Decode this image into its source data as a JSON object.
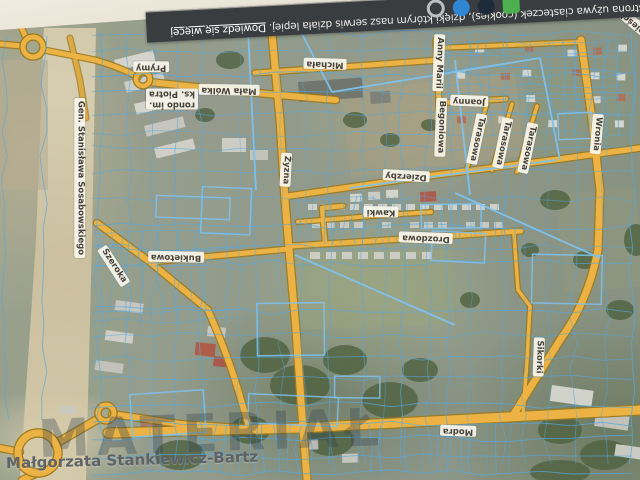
{
  "photo": {
    "background_color": "#e7e2d4"
  },
  "banner": {
    "bg_color": "#393d3f",
    "message": "Ta strona używa ciasteczek (cookies), dzięki którym nasz serwis działa lepiej. ",
    "link_label": "Dowiedz się więcej",
    "icons": [
      {
        "name": "green-app-icon",
        "shape": "square",
        "color": "#4caf50"
      },
      {
        "name": "dark-circle-icon",
        "shape": "circle",
        "color": "#1d2b3a"
      },
      {
        "name": "blue-circle-icon",
        "shape": "circle",
        "color": "#2f87d4"
      },
      {
        "name": "ring-icon",
        "shape": "ring",
        "color": "#b9bfc2"
      }
    ]
  },
  "map": {
    "colors": {
      "road_fill": "#ecb244",
      "road_casing": "#9c7a1e",
      "parcel_line": "#55a8e0",
      "parcel_strong": "#7ec2ee",
      "label_bg": "#f8f5ec",
      "label_text": "#46423a",
      "sand": "#d2c6a6",
      "banner_bg": "#393d3f"
    },
    "watermark_text": "MATERIAŁ",
    "credit_text": "Małgorzata Stankiewicz-Bartz",
    "street_labels": [
      {
        "id": "gen-stanislawa-sosabowskiego",
        "text": "Gen. Stanisława Sosabowskiego",
        "x": 80,
        "y": 178,
        "rot": 90
      },
      {
        "id": "szeroka",
        "text": "Szeroka",
        "x": 114,
        "y": 266,
        "rot": 57
      },
      {
        "id": "bukietowa",
        "text": "Bukietowa",
        "x": 176,
        "y": 257,
        "rot": 181
      },
      {
        "id": "zyzna",
        "text": "Żyzna",
        "x": 286,
        "y": 170,
        "rot": 93
      },
      {
        "id": "mala-wolka",
        "text": "Mała Wólka",
        "x": 229,
        "y": 90,
        "rot": 181
      },
      {
        "id": "rondo-ks-piotra",
        "text": "rondo im.\nks. Piotra",
        "x": 172,
        "y": 99,
        "rot": 180
      },
      {
        "id": "prymy",
        "text": "Prymy",
        "x": 151,
        "y": 67,
        "rot": 180
      },
      {
        "id": "michala",
        "text": "Michała",
        "x": 325,
        "y": 64,
        "rot": 182
      },
      {
        "id": "anny-marii",
        "text": "Anny Marii",
        "x": 439,
        "y": 63,
        "rot": 92
      },
      {
        "id": "joanny",
        "text": "Joanny",
        "x": 469,
        "y": 101,
        "rot": 182
      },
      {
        "id": "begoniowa",
        "text": "Begoniowa",
        "x": 441,
        "y": 127,
        "rot": 92
      },
      {
        "id": "tarasowa-1",
        "text": "Tarasowa",
        "x": 477,
        "y": 139,
        "rot": 102
      },
      {
        "id": "tarasowa-2",
        "text": "Tarasowa",
        "x": 503,
        "y": 143,
        "rot": 102
      },
      {
        "id": "tarasowa-3",
        "text": "Tarasowa",
        "x": 528,
        "y": 148,
        "rot": 102
      },
      {
        "id": "wronia",
        "text": "Wronia",
        "x": 597,
        "y": 134,
        "rot": 95
      },
      {
        "id": "dzierzby",
        "text": "Dzierzby",
        "x": 406,
        "y": 176,
        "rot": 183
      },
      {
        "id": "kawki",
        "text": "Kawki",
        "x": 381,
        "y": 212,
        "rot": 181
      },
      {
        "id": "drozdowa",
        "text": "Drozdowa",
        "x": 426,
        "y": 238,
        "rot": 182
      },
      {
        "id": "sikorki",
        "text": "Sikorki",
        "x": 539,
        "y": 357,
        "rot": 92
      },
      {
        "id": "modra",
        "text": "Modra",
        "x": 458,
        "y": 431,
        "rot": 182
      },
      {
        "id": "zamiescie",
        "text": "Zamieście",
        "x": 637,
        "y": 26,
        "rot": 220
      }
    ]
  }
}
